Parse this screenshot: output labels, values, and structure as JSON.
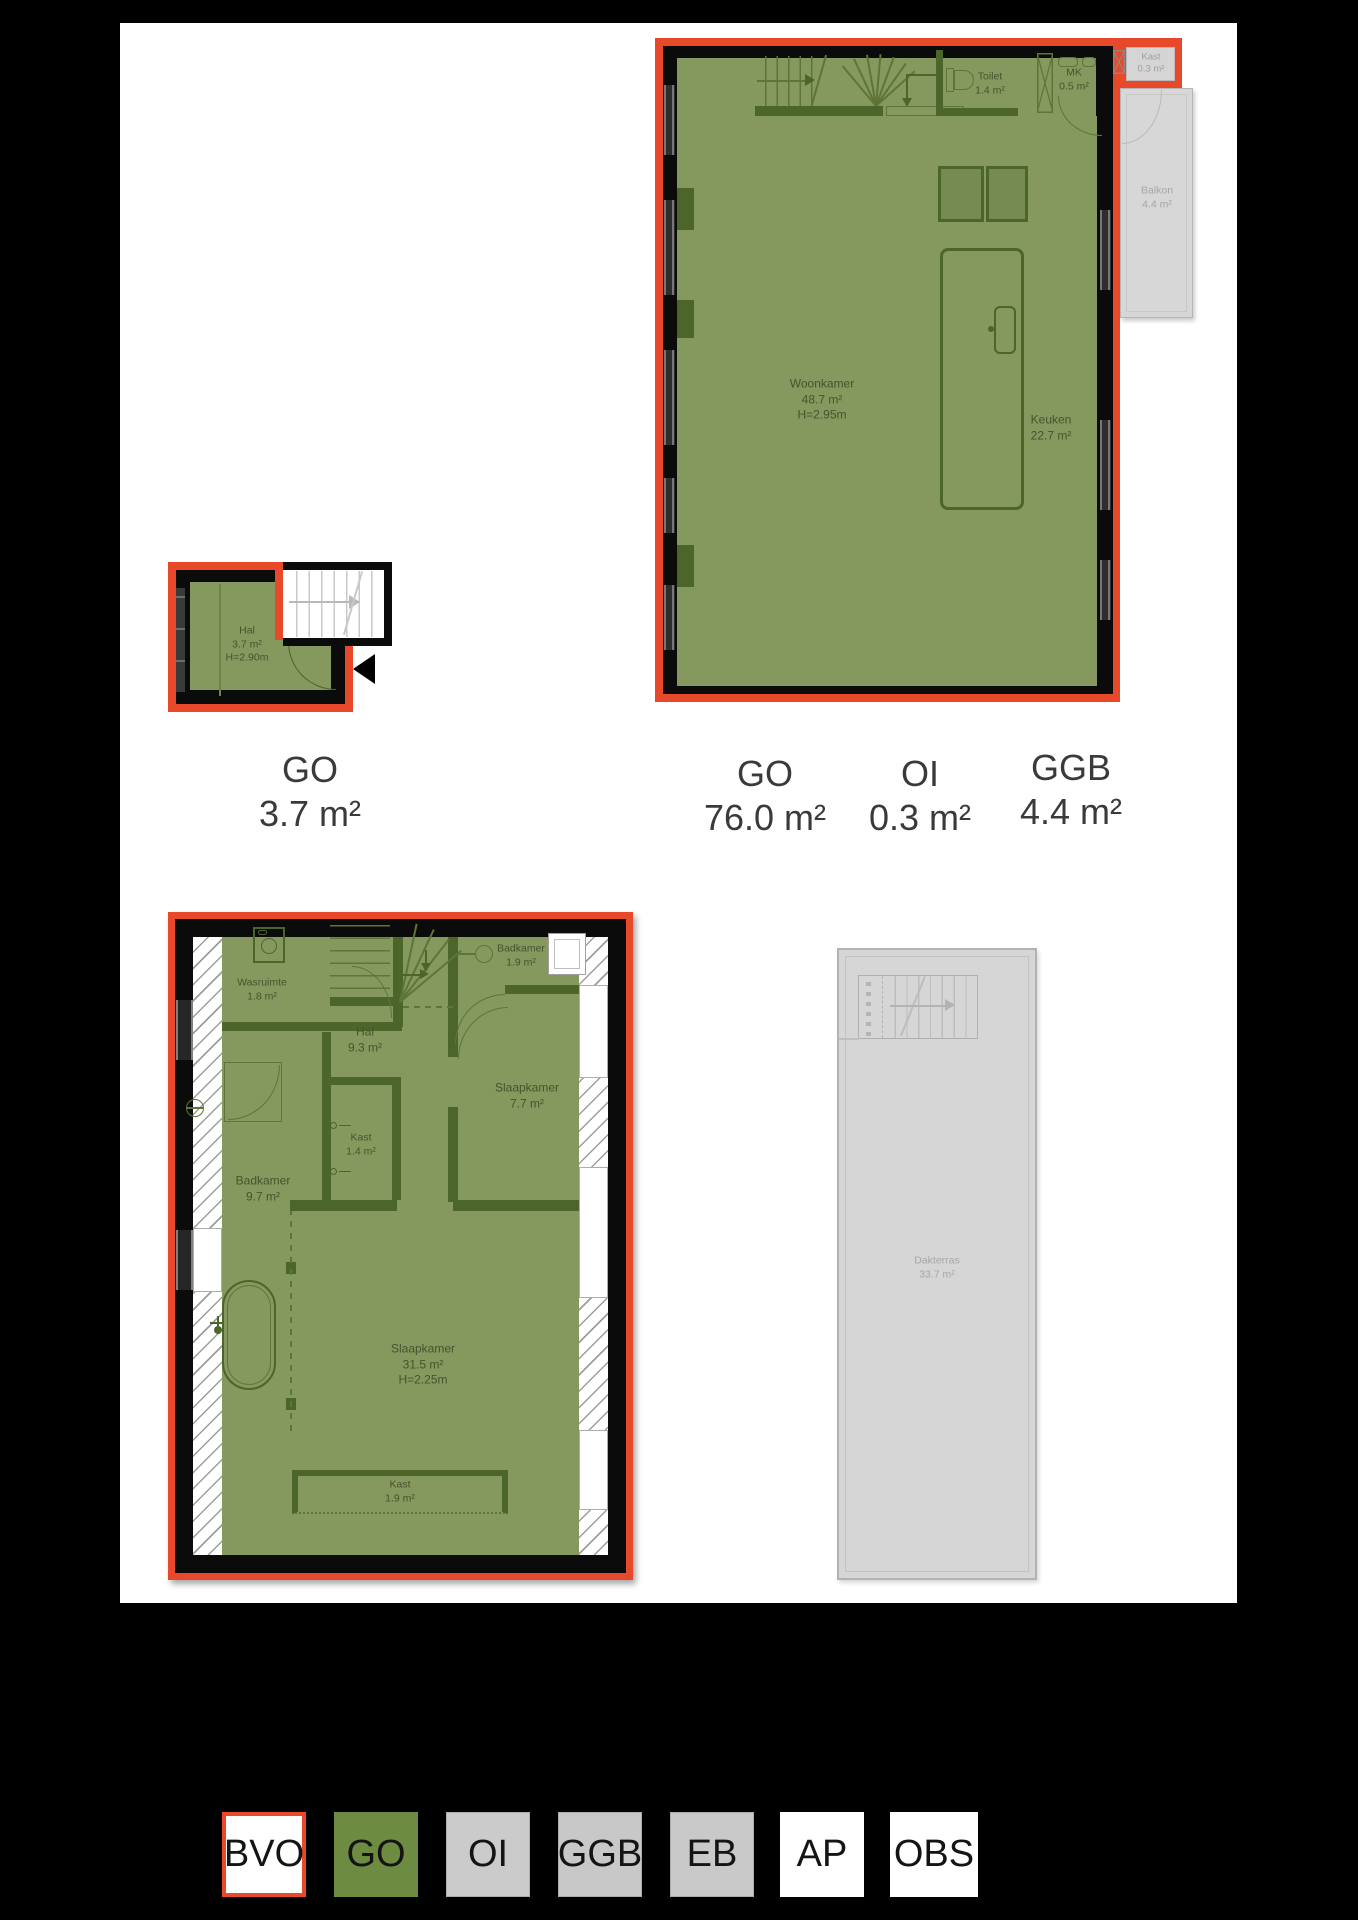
{
  "colors": {
    "go_fill": "#85985e",
    "wall_green": "#4c652a",
    "outline_red": "#e8492b",
    "grey_fill": "#d6d6d6",
    "legend_go_green": "#6e8b42"
  },
  "plan_ground_floor": {
    "rooms": {
      "hal": {
        "name": "Hal",
        "area": "3.7 m²",
        "height": "H=2.90m"
      }
    },
    "caption": {
      "code": "GO",
      "value": "3.7 m²"
    }
  },
  "plan_first_floor": {
    "rooms": {
      "woonkamer": {
        "name": "Woonkamer",
        "area": "48.7 m²",
        "height": "H=2.95m"
      },
      "keuken": {
        "name": "Keuken",
        "area": "22.7 m²"
      },
      "toilet": {
        "name": "Toilet",
        "area": "1.4 m²"
      },
      "mk": {
        "name": "MK",
        "area": "0.5 m²"
      },
      "kast": {
        "name": "Kast",
        "area": "0.3 m²"
      },
      "balkon": {
        "name": "Balkon",
        "area": "4.4 m²"
      }
    },
    "captions": [
      {
        "code": "GO",
        "value": "76.0 m²"
      },
      {
        "code": "OI",
        "value": "0.3 m²"
      },
      {
        "code": "GGB",
        "value": "4.4 m²"
      }
    ]
  },
  "plan_second_floor": {
    "rooms": {
      "wasruimte": {
        "name": "Wasruimte",
        "area": "1.8 m²"
      },
      "hal": {
        "name": "Hal",
        "area": "9.3 m²"
      },
      "badkamer_small": {
        "name": "Badkamer",
        "area": "1.9 m²"
      },
      "slaapkamer_small": {
        "name": "Slaapkamer",
        "area": "7.7 m²"
      },
      "kast_small": {
        "name": "Kast",
        "area": "1.4 m²"
      },
      "badkamer_large": {
        "name": "Badkamer",
        "area": "9.7 m²"
      },
      "slaapkamer_large": {
        "name": "Slaapkamer",
        "area": "31.5 m²",
        "height": "H=2.25m"
      },
      "kast_large": {
        "name": "Kast",
        "area": "1.9 m²"
      }
    }
  },
  "plan_roof_terrace": {
    "rooms": {
      "dakterras": {
        "name": "Dakterras",
        "area": "33.7 m²"
      }
    }
  },
  "legend": {
    "items": [
      {
        "label": "BVO"
      },
      {
        "label": "GO"
      },
      {
        "label": "OI"
      },
      {
        "label": "GGB"
      },
      {
        "label": "EB"
      },
      {
        "label": "AP"
      },
      {
        "label": "OBS"
      }
    ]
  }
}
